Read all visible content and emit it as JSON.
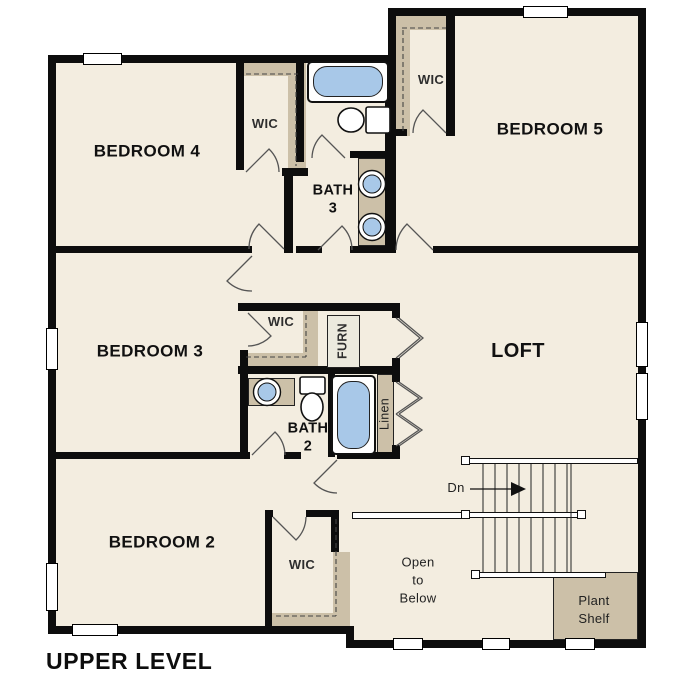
{
  "title": "UPPER LEVEL",
  "colors": {
    "floor": "#f3ede0",
    "shelf_tan": "#ccc0a8",
    "fixture_blue": "#a8c8e8",
    "wall": "#0d0d0d"
  },
  "rooms": {
    "bedroom4": "BEDROOM 4",
    "bedroom5": "BEDROOM 5",
    "bedroom3": "BEDROOM 3",
    "bedroom2": "BEDROOM 2",
    "loft": "LOFT",
    "bath3": "BATH\n3",
    "bath2": "BATH\n2"
  },
  "closets": {
    "wic_bedroom4": "WIC",
    "wic_bedroom5": "WIC",
    "wic_bedroom3": "WIC",
    "wic_bedroom2": "WIC",
    "furnace": "FURN",
    "linen": "Linen"
  },
  "annotations": {
    "stairs_down": "Dn",
    "open_to_below": "Open\nto\nBelow",
    "plant_shelf": "Plant\nShelf"
  }
}
